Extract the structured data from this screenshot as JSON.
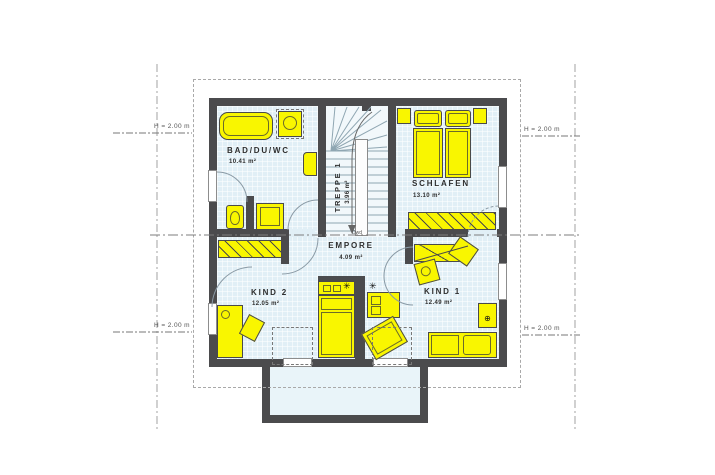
{
  "rooms": {
    "bad": {
      "name": "BAD/DU/WC",
      "area": "10.41 m²"
    },
    "treppe": {
      "name": "TREPPE 1",
      "area": "3.96 m²"
    },
    "schlafen": {
      "name": "SCHLAFEN",
      "area": "13.10 m²"
    },
    "empore": {
      "name": "EMPORE",
      "area": "4.09 m²"
    },
    "kind2": {
      "name": "KIND 2",
      "area": "12.05 m²"
    },
    "kind1": {
      "name": "KIND 1",
      "area": "12.49 m²"
    }
  },
  "markers": {
    "height_left_top": "H = 2.00 m",
    "height_left_bottom": "H = 2.00 m",
    "height_right_top": "H = 2.00 m",
    "height_right_bottom": "H = 2.00 m",
    "stair_bottom_note": "Dwd"
  },
  "symbols": {
    "ceiling_light_left": "✳",
    "ceiling_light_right": "✳",
    "vent": "⊕"
  },
  "colors": {
    "wall": "#4b4b4d",
    "furniture_yellow": "#f9f600",
    "floor_blue": "#e1eff6",
    "dash_gray": "#999999"
  }
}
